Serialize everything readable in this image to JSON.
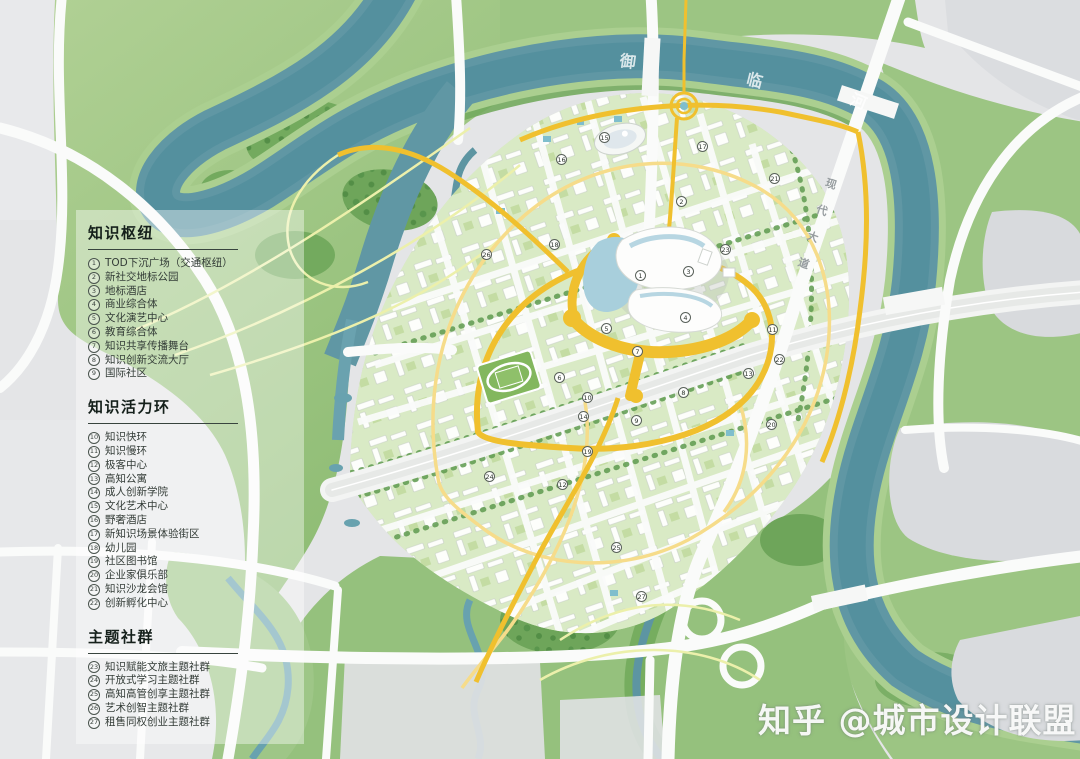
{
  "watermark": {
    "text": "知乎 @城市设计联盟"
  },
  "map": {
    "river_name": "御临河",
    "river_labels": [
      "御",
      "临",
      "河"
    ],
    "road_label": "现代大道",
    "colors": {
      "river": "#5d95a2",
      "ring_yellow": "#f0c02e",
      "park_green": "#9cc583",
      "block_green": "#d9eac6",
      "legend_ink": "#333c37"
    },
    "markers": [
      {
        "n": 1,
        "x": 641,
        "y": 276
      },
      {
        "n": 2,
        "x": 682,
        "y": 202
      },
      {
        "n": 3,
        "x": 689,
        "y": 272
      },
      {
        "n": 4,
        "x": 686,
        "y": 318
      },
      {
        "n": 5,
        "x": 607,
        "y": 329
      },
      {
        "n": 6,
        "x": 560,
        "y": 378
      },
      {
        "n": 7,
        "x": 638,
        "y": 352
      },
      {
        "n": 8,
        "x": 684,
        "y": 393
      },
      {
        "n": 9,
        "x": 637,
        "y": 421
      },
      {
        "n": 10,
        "x": 588,
        "y": 398
      },
      {
        "n": 11,
        "x": 773,
        "y": 330
      },
      {
        "n": 12,
        "x": 563,
        "y": 485
      },
      {
        "n": 13,
        "x": 749,
        "y": 374
      },
      {
        "n": 14,
        "x": 584,
        "y": 417
      },
      {
        "n": 15,
        "x": 605,
        "y": 138
      },
      {
        "n": 16,
        "x": 562,
        "y": 160
      },
      {
        "n": 17,
        "x": 703,
        "y": 147
      },
      {
        "n": 18,
        "x": 555,
        "y": 245
      },
      {
        "n": 19,
        "x": 588,
        "y": 452
      },
      {
        "n": 20,
        "x": 772,
        "y": 425
      },
      {
        "n": 21,
        "x": 775,
        "y": 179
      },
      {
        "n": 22,
        "x": 780,
        "y": 360
      },
      {
        "n": 23,
        "x": 726,
        "y": 250
      },
      {
        "n": 24,
        "x": 490,
        "y": 477
      },
      {
        "n": 25,
        "x": 617,
        "y": 548
      },
      {
        "n": 26,
        "x": 487,
        "y": 255
      },
      {
        "n": 27,
        "x": 642,
        "y": 597
      }
    ]
  },
  "legend": {
    "sections": [
      {
        "title": "知识枢纽",
        "items": [
          {
            "n": 1,
            "label": "TOD下沉广场（交通枢纽）"
          },
          {
            "n": 2,
            "label": "新社交地标公园"
          },
          {
            "n": 3,
            "label": "地标酒店"
          },
          {
            "n": 4,
            "label": "商业综合体"
          },
          {
            "n": 5,
            "label": "文化演艺中心"
          },
          {
            "n": 6,
            "label": "教育综合体"
          },
          {
            "n": 7,
            "label": "知识共享传播舞台"
          },
          {
            "n": 8,
            "label": "知识创新交流大厅"
          },
          {
            "n": 9,
            "label": "国际社区"
          }
        ]
      },
      {
        "title": "知识活力环",
        "items": [
          {
            "n": 10,
            "label": "知识快环"
          },
          {
            "n": 11,
            "label": "知识慢环"
          },
          {
            "n": 12,
            "label": "极客中心"
          },
          {
            "n": 13,
            "label": "高知公寓"
          },
          {
            "n": 14,
            "label": "成人创新学院"
          },
          {
            "n": 15,
            "label": "文化艺术中心"
          },
          {
            "n": 16,
            "label": "野奢酒店"
          },
          {
            "n": 17,
            "label": "新知识场景体验街区"
          },
          {
            "n": 18,
            "label": "幼儿园"
          },
          {
            "n": 19,
            "label": "社区图书馆"
          },
          {
            "n": 20,
            "label": "企业家俱乐部"
          },
          {
            "n": 21,
            "label": "知识沙龙会馆"
          },
          {
            "n": 22,
            "label": "创新孵化中心"
          }
        ]
      },
      {
        "title": "主题社群",
        "items": [
          {
            "n": 23,
            "label": "知识赋能文旅主题社群"
          },
          {
            "n": 24,
            "label": "开放式学习主题社群"
          },
          {
            "n": 25,
            "label": "高知高管创享主题社群"
          },
          {
            "n": 26,
            "label": "艺术创智主题社群"
          },
          {
            "n": 27,
            "label": "租售同权创业主题社群"
          }
        ]
      }
    ]
  }
}
